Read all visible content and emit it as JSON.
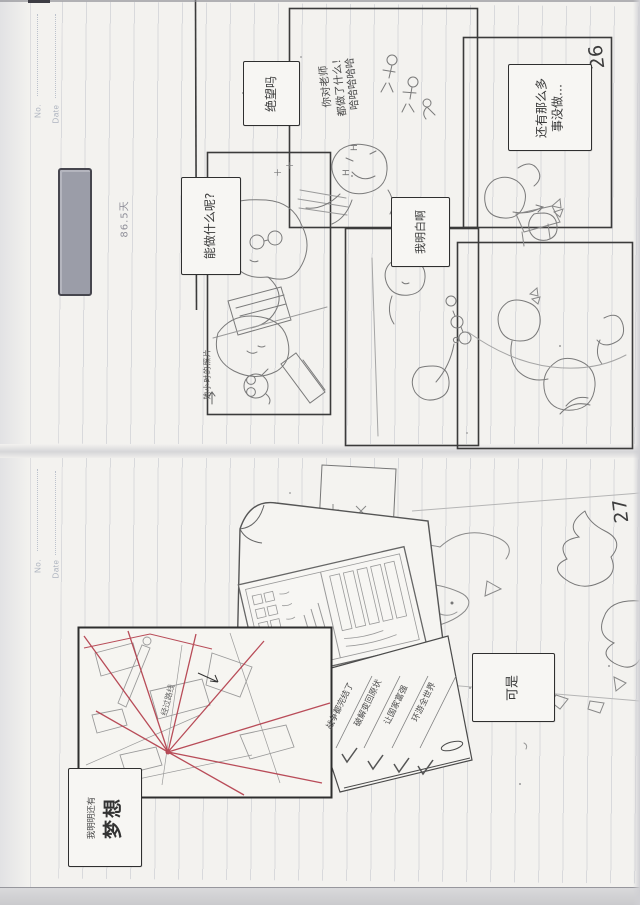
{
  "scan": {
    "page_top": {
      "page_number": "26",
      "header": {
        "no": "No.",
        "date": "Date"
      },
      "notes": {
        "days": "86.5天",
        "photo": "她小时的照片"
      },
      "bubbles": {
        "what_can_do": "能做什么呢?",
        "despair": "绝望吗",
        "i_see": "我明白啊",
        "so_much": "还有那么多\n事没做…",
        "shout": "你对老师\n都做了什么！\n哈哈哈哈哈"
      },
      "marks": {
        "h1": "H",
        "h2": "H",
        "p1": "＋",
        "p2": "＋"
      }
    },
    "page_bottom": {
      "page_number": "27",
      "header": {
        "no": "No.",
        "date": "Date"
      },
      "bubbles": {
        "but": "可是",
        "dream_prefix": "我明明还有",
        "dream": "梦想"
      },
      "checklist": [
        "战争都完结了",
        "破解变回原状",
        "让国家富强",
        "环游全世界"
      ],
      "map_note": "经过路线"
    }
  }
}
